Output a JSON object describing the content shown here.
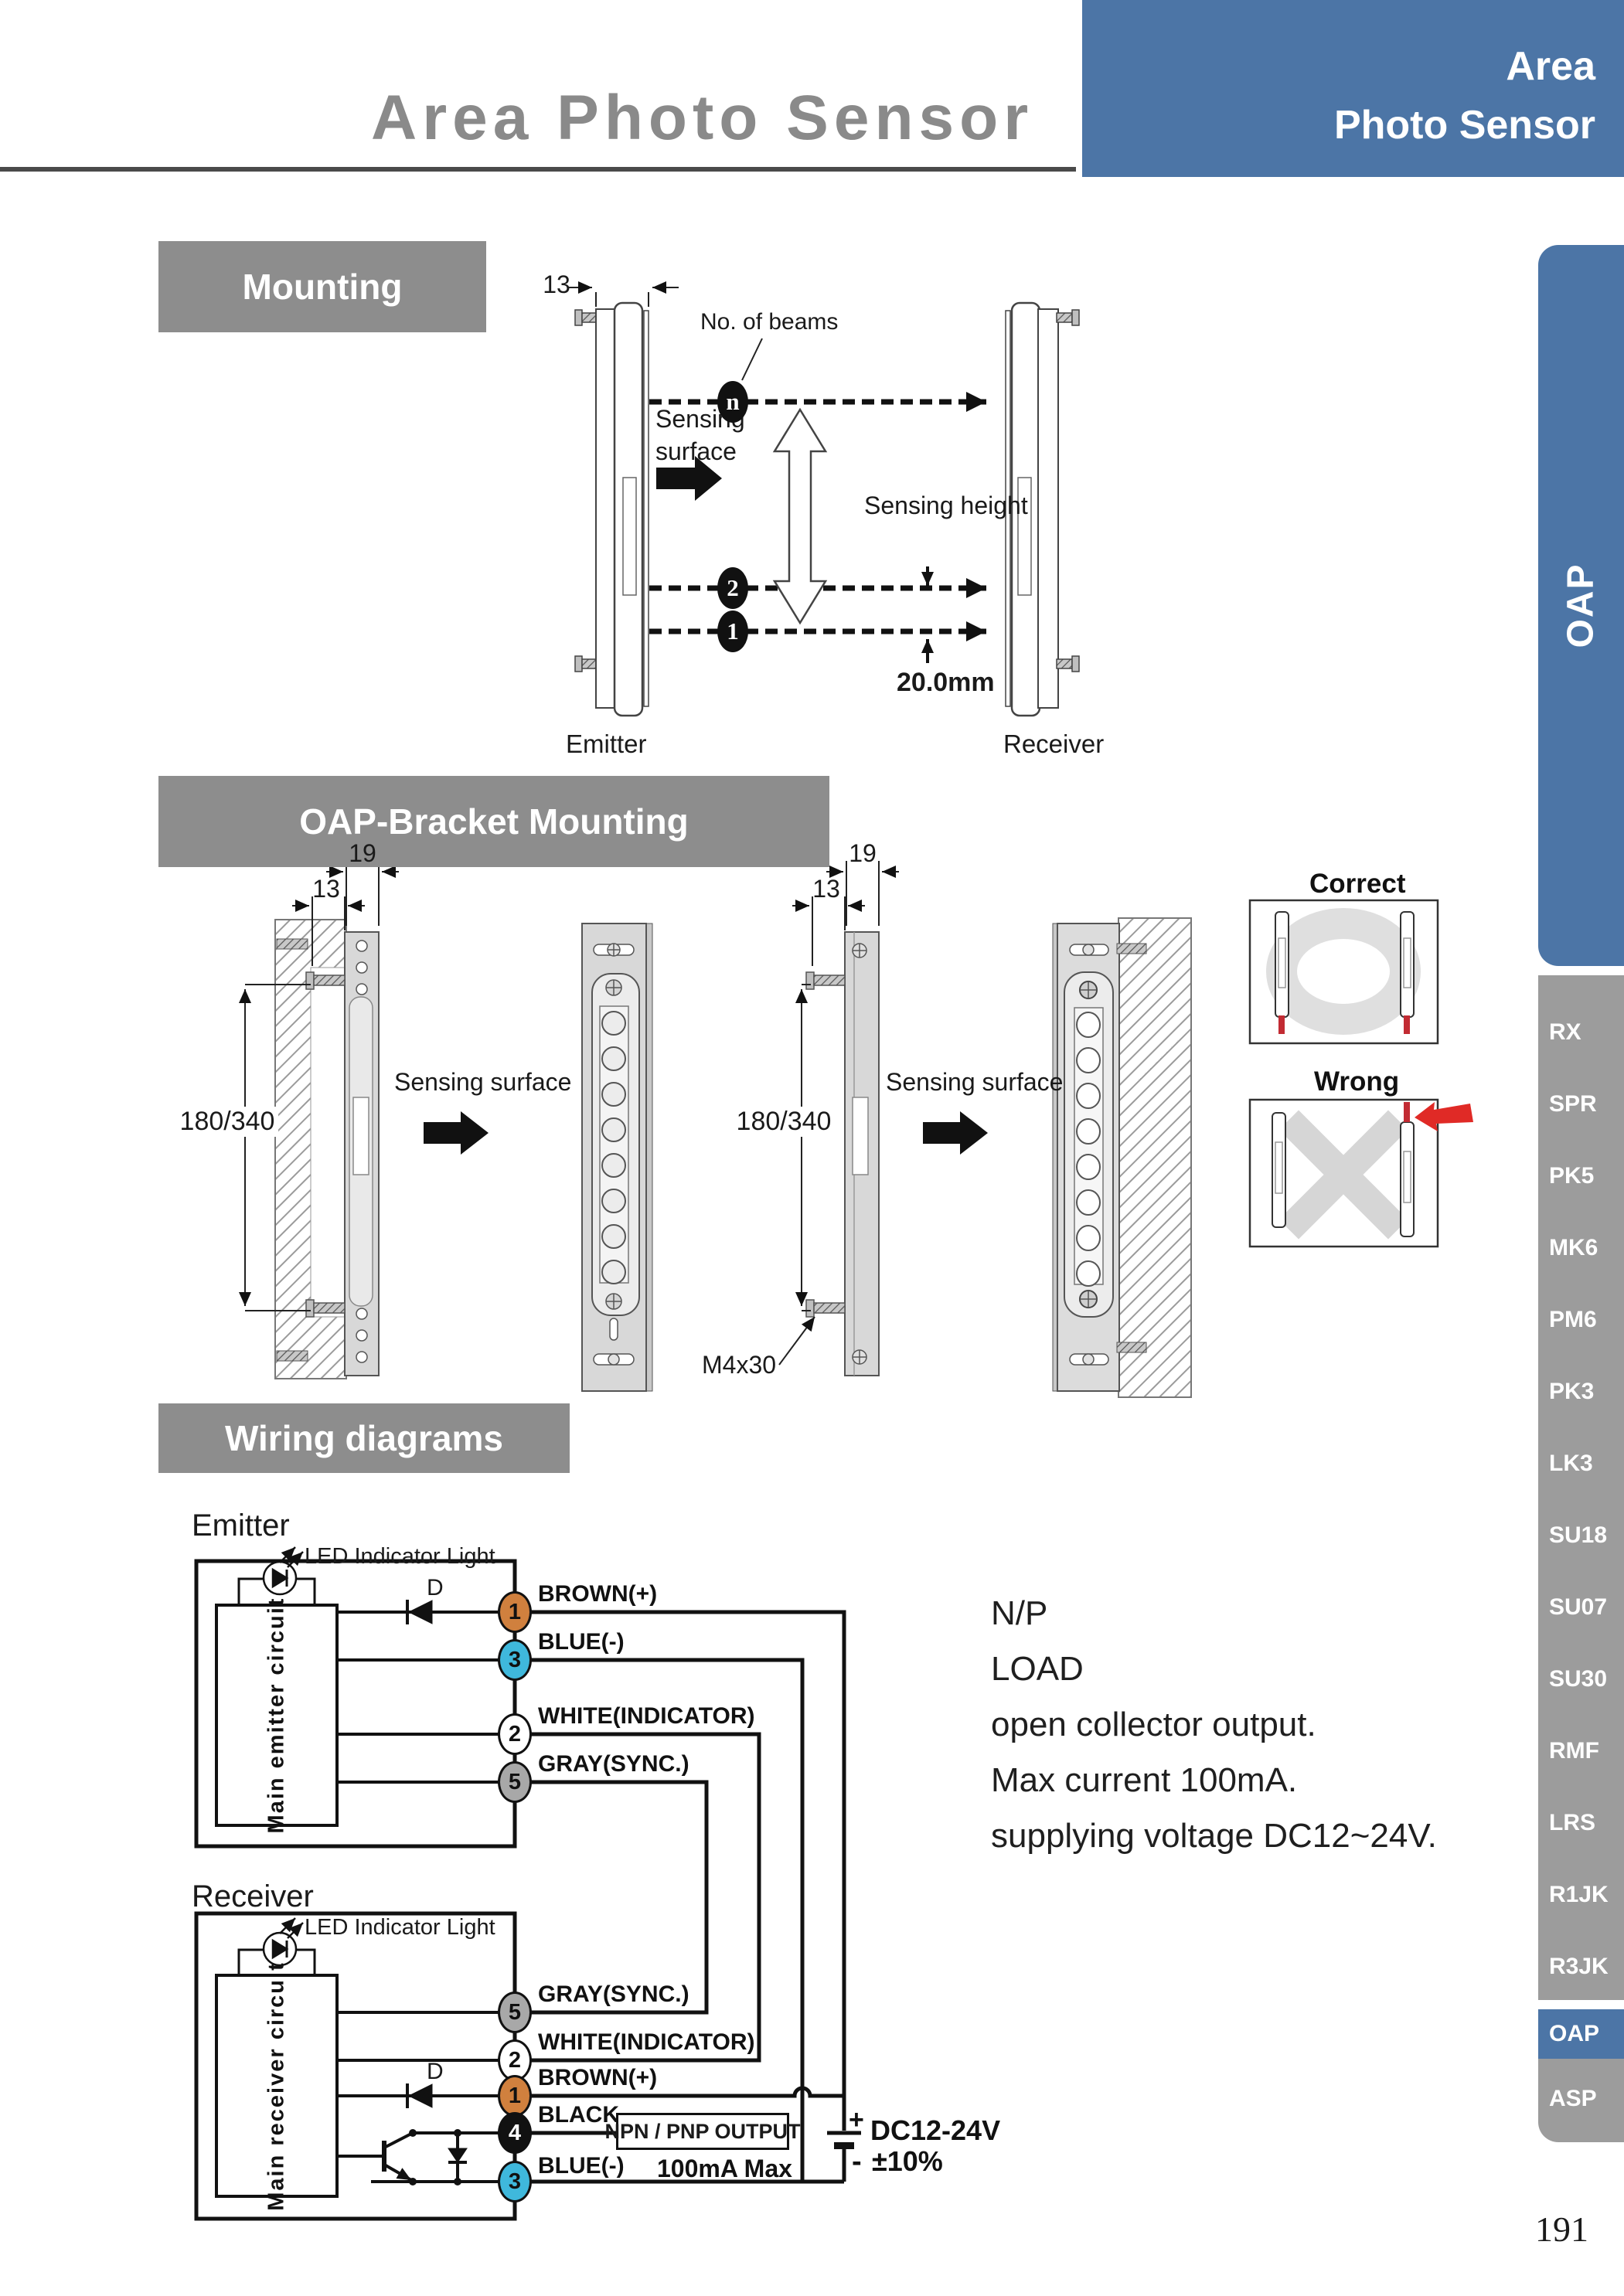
{
  "header": {
    "title": "Area Photo Sensor",
    "badge": {
      "line1": "Area",
      "line2": "Photo Sensor"
    }
  },
  "sections": {
    "mounting": "Mounting",
    "bracket": "OAP-Bracket Mounting",
    "wiring": "Wiring diagrams"
  },
  "mounting": {
    "dim_width": "13",
    "no_of_beams": "No. of beams",
    "beam_top": "n",
    "beam_second": "2",
    "beam_first": "1",
    "sensing_surface_line1": "Sensing",
    "sensing_surface_line2": "surface",
    "sensing_height": "Sensing height",
    "beam_gap": "20.0mm",
    "emitter_label": "Emitter",
    "receiver_label": "Receiver"
  },
  "bracket": {
    "dim_depth": "19",
    "dim_width": "13",
    "dim_height": "180/340",
    "sensing_surface": "Sensing surface",
    "screw_spec": "M4x30",
    "correct_label": "Correct",
    "wrong_label": "Wrong"
  },
  "wiring": {
    "emitter_title": "Emitter",
    "receiver_title": "Receiver",
    "led_label": "LED Indicator Light",
    "emitter_circuit": "Main emitter circuit",
    "receiver_circuit": "Main receiver circuit",
    "diode_label": "D",
    "terminals": {
      "brown": {
        "num": "1",
        "label": "BROWN(+)"
      },
      "blue": {
        "num": "3",
        "label": "BLUE(-)"
      },
      "white": {
        "num": "2",
        "label": "WHITE(INDICATOR)"
      },
      "gray": {
        "num": "5",
        "label": "GRAY(SYNC.)"
      },
      "black": {
        "num": "4",
        "label": "BLACK"
      }
    },
    "output_box": "NPN / PNP OUTPUT",
    "max_current": "100mA Max",
    "supply": "DC12-24V",
    "tolerance": "±10%",
    "plus": "+",
    "minus": "-"
  },
  "notes": {
    "line1": "N/P",
    "line2": "LOAD",
    "line3": "open collector output.",
    "line4": "Max current 100mA.",
    "line5": "supplying voltage DC12~24V."
  },
  "sidebar": {
    "tab_label": "OAP",
    "items": [
      "RX",
      "SPR",
      "PK5",
      "MK6",
      "PM6",
      "PK3",
      "LK3",
      "SU18",
      "SU07",
      "SU30",
      "RMF",
      "LRS",
      "R1JK",
      "R3JK"
    ],
    "active_item": "OAP",
    "last_item": "ASP"
  },
  "page_number": "191",
  "colors": {
    "accent_blue": "#4C75A6",
    "section_gray": "#8D8D8D",
    "sidebar_gray": "#9C9C9C",
    "wire_brown": "#D0803E",
    "wire_blue": "#3FB8DC",
    "wire_gray": "#A8A8A8",
    "alert_red": "#E02A26"
  }
}
